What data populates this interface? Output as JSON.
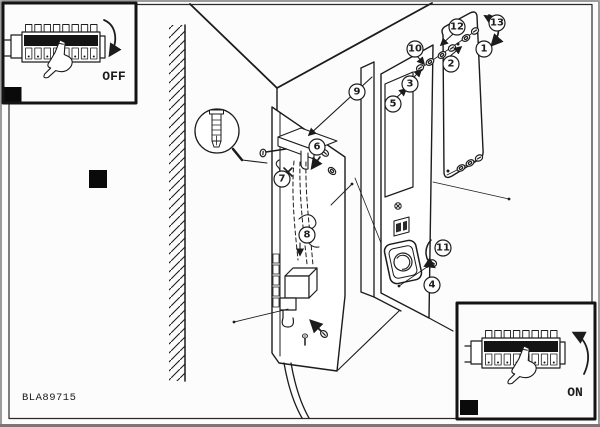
{
  "figure": {
    "code": "BLA89715",
    "background_color": "#fcfcfc",
    "line_color": "#1c1c1c",
    "marker_color": "#0a0a0a"
  },
  "insets": {
    "power_off": {
      "label": "OFF",
      "icon": "pointing-hand-icon",
      "arrow_icon": "rotate-down-arrow-icon"
    },
    "power_on": {
      "label": "ON",
      "icon": "pointing-hand-icon",
      "arrow_icon": "rotate-up-arrow-icon"
    }
  },
  "callouts": {
    "labels": [
      "1",
      "2",
      "3",
      "4",
      "5",
      "6",
      "7",
      "8",
      "9",
      "10",
      "11",
      "12",
      "13"
    ]
  }
}
